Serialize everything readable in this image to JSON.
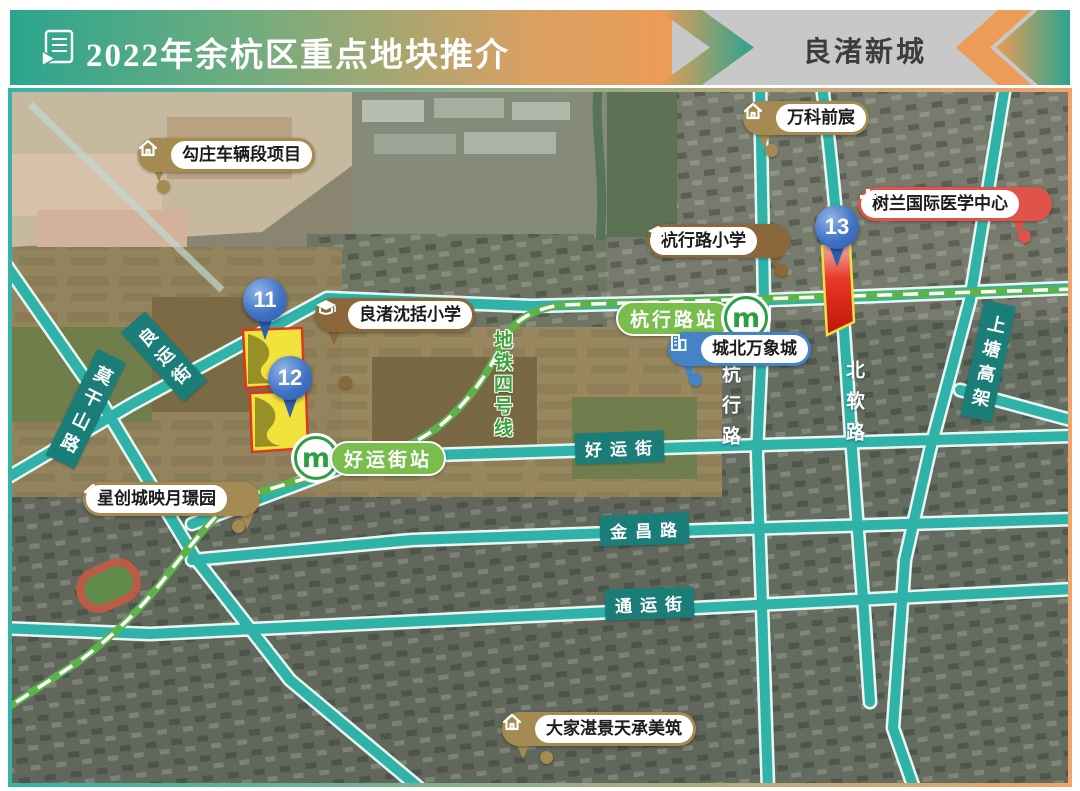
{
  "header": {
    "title": "2022年余杭区重点地块推介",
    "region_tab": "良渚新城"
  },
  "map": {
    "markers": [
      "11",
      "12",
      "13"
    ],
    "pois": [
      {
        "name": "勾庄车辆段项目",
        "type": "residential-project",
        "icon": "home-icon"
      },
      {
        "name": "万科前宸",
        "type": "residential-project",
        "icon": "home-icon"
      },
      {
        "name": "树兰国际医学中心",
        "type": "hospital",
        "icon": "medical-cross-icon"
      },
      {
        "name": "杭行路小学",
        "type": "school",
        "icon": "graduation-cap-icon"
      },
      {
        "name": "良渚沈括小学",
        "type": "school",
        "icon": "graduation-cap-icon"
      },
      {
        "name": "城北万象城",
        "type": "mall",
        "icon": "building-icon"
      },
      {
        "name": "星创城映月璟园",
        "type": "residential-project",
        "icon": "home-icon"
      },
      {
        "name": "大家湛景天承美筑",
        "type": "residential-project",
        "icon": "home-icon"
      }
    ],
    "stations": [
      {
        "name": "杭行路站",
        "logo": "m"
      },
      {
        "name": "好运街站",
        "logo": "m"
      }
    ],
    "road_labels": [
      "良运街",
      "莫干山路",
      "地铁四号线",
      "好运街",
      "金昌路",
      "通运街",
      "杭行路",
      "北软路",
      "上塘高架"
    ]
  },
  "colors": {
    "header_teal": "#2AA58F",
    "header_orange": "#EC9C57",
    "road_teal": "#2FB3A9",
    "road_label_bg": "#1A7D78",
    "metro_green": "#5CB34A",
    "poi_gold": "#A58B51",
    "poi_school_brown": "#8A683A",
    "poi_blue": "#4484C6",
    "poi_red": "#DF5348",
    "plot_yellow": "#F2E23C",
    "plot_red": "#E8392B",
    "pin_blue": "#3B6FC0"
  }
}
